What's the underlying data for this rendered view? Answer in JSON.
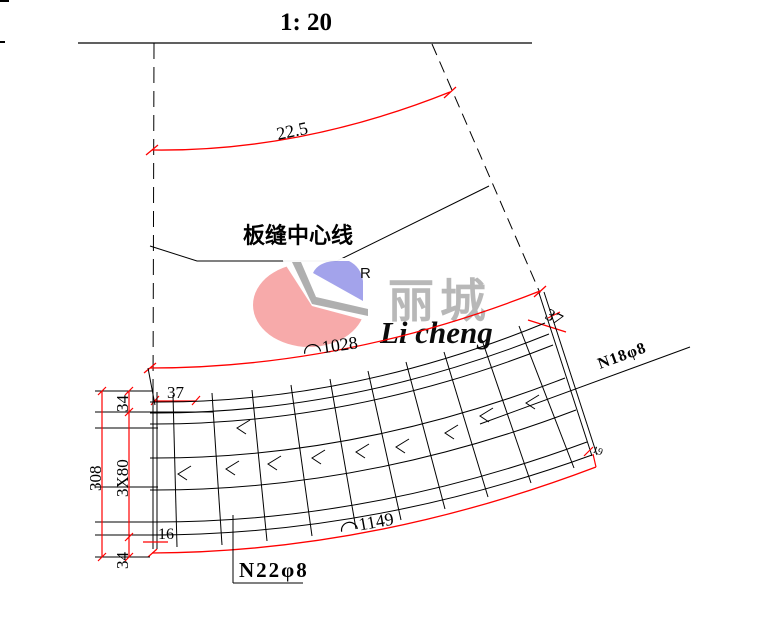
{
  "drawing": {
    "scale_label": "1: 20",
    "joint_centerline_label": "板缝中心线",
    "dims": {
      "top_arc_dim": "22.5",
      "arc_top_length": "1028",
      "arc_bottom_length": "1149",
      "grid_spacing": "9×106",
      "margin_left": "37",
      "margin_right": "37",
      "height_total": "308",
      "height_spacing": "3X80",
      "margin_top": "34",
      "margin_bottom": "34",
      "offset_bottom_left": "16",
      "offset_bottom_right": "19"
    },
    "bars": {
      "n18_label": "N18φ8",
      "n22_label": "N22φ8"
    }
  },
  "logo": {
    "r_mark": "R",
    "name_cn": "丽城",
    "name_en": "Li cheng"
  },
  "colors": {
    "dim_red": "#ff0000",
    "line_black": "#000000",
    "logo_pink": "#f7a6a6",
    "logo_blue": "#9f9fea",
    "logo_gray": "#ababab",
    "logo_text_gray": "#b5b5b5"
  }
}
